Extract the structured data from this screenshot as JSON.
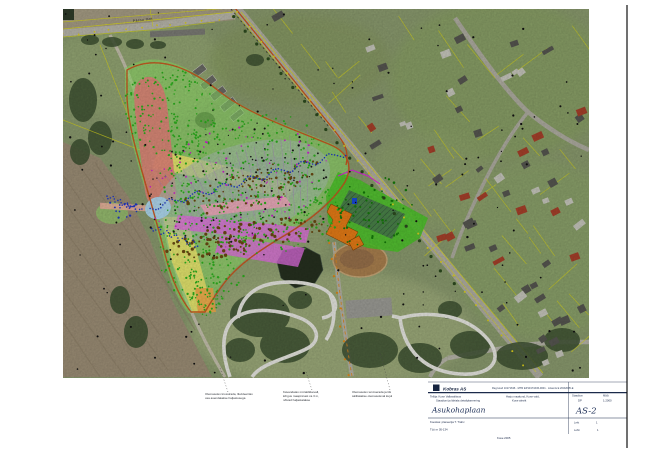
{
  "road_label": "Pärnu mnt",
  "notes": [
    {
      "lines": [
        "Olemasolev krossirada, likvideeritav",
        "osa asendatakse haljastusega"
      ]
    },
    {
      "lines": [
        "Kavandatav müratõkkevall,",
        "kõrgus maapinnast ca 3 m,",
        "nõlvad haljastatakse"
      ]
    },
    {
      "lines": [
        "Olemasolev terviserada ja tiik",
        "säilitatakse olemasoleval kujul"
      ]
    }
  ],
  "title_block": {
    "logo_text": "Kobras AS",
    "top_refs": "Reg kood 10171636  ·  MTR EP10171636-0001  ·  Litsents E 203/2005-E",
    "client_label": "Tellija: Kose Vallavalitsus",
    "project_label": "Staadioni ja lähiala detailplaneering",
    "location_line1": "Harju maakond, Kose vald,",
    "location_line2": "Kose alevik",
    "stage_label": "Staadium",
    "stage_value": "DP",
    "scale_label": "Mõõt",
    "scale_value": "1:2000",
    "title_big": "Asukohaplaan",
    "number_big": "AS-2",
    "author_line": "Koostas: planeerija T. Trahv",
    "work_no_line": "Töö nr 05-134",
    "sheet_label": "Leht",
    "sheet_value": "1",
    "sheets_label": "Lehti",
    "sheets_value": "1",
    "footer_center": "Kose 2005"
  },
  "colors": {
    "overlay_green": "#8fe868",
    "zone_red": "#e2837a",
    "zone_yellow": "#f2ea6e",
    "zone_orange": "#f0a84a",
    "zone_magenta": "#e26ee2",
    "zone_pink": "#f2a8bc",
    "zone_blue": "#aed9f2",
    "zone_salmon_strip": "#f0b0a0",
    "oval_fill": "#a9bfae",
    "oval_hatch": "#b07ad0",
    "facility_green": "#4cc32a",
    "facility_orange": "#e57b16",
    "boundary_orange": "#c8551e",
    "navy": "#1b2a4a"
  },
  "map": {
    "oval": {
      "cx": 243,
      "cy": 190,
      "rx": 90,
      "ry": 45,
      "rot": -17,
      "hatch_n": 18
    },
    "dot_groups": [
      {
        "seed": 21,
        "cx": 170,
        "cy": 112,
        "rx": 48,
        "ry": 44,
        "rot": 0,
        "n": 150,
        "color": "#2db01e",
        "r": 0.7,
        "rv": 0.5
      },
      {
        "seed": 22,
        "cx": 240,
        "cy": 162,
        "rx": 82,
        "ry": 46,
        "rot": -15,
        "n": 220,
        "color": "#2db01e",
        "r": 0.7,
        "rv": 0.5
      },
      {
        "seed": 23,
        "cx": 205,
        "cy": 245,
        "rx": 48,
        "ry": 58,
        "rot": 5,
        "n": 170,
        "color": "#2db01e",
        "r": 0.7,
        "rv": 0.5
      },
      {
        "seed": 24,
        "cx": 290,
        "cy": 220,
        "rx": 58,
        "ry": 38,
        "rot": -20,
        "n": 130,
        "color": "#2db01e",
        "r": 0.7,
        "rv": 0.5
      },
      {
        "seed": 25,
        "cx": 205,
        "cy": 292,
        "rx": 20,
        "ry": 26,
        "rot": 0,
        "n": 45,
        "color": "#2db01e",
        "r": 0.7,
        "rv": 0.5
      },
      {
        "seed": 31,
        "cx": 235,
        "cy": 185,
        "rx": 95,
        "ry": 60,
        "rot": -15,
        "n": 90,
        "color": "#1c1c1c",
        "r": 0.6,
        "rv": 0.5
      },
      {
        "seed": 32,
        "cx": 235,
        "cy": 185,
        "rx": 95,
        "ry": 60,
        "rot": -15,
        "n": 70,
        "color": "#d020d0",
        "r": 0.6,
        "rv": 0.5
      },
      {
        "seed": 33,
        "cx": 245,
        "cy": 238,
        "rx": 80,
        "ry": 16,
        "rot": -10,
        "n": 110,
        "color": "#6b4a12",
        "r": 0.9,
        "rv": 0.8
      },
      {
        "seed": 34,
        "cx": 250,
        "cy": 188,
        "rx": 75,
        "ry": 18,
        "rot": -17,
        "n": 80,
        "color": "#6b4a12",
        "r": 0.8,
        "rv": 0.7
      },
      {
        "seed": 35,
        "cx": 372,
        "cy": 212,
        "rx": 42,
        "ry": 34,
        "rot": -20,
        "n": 55,
        "color": "#157a0a",
        "r": 0.8,
        "rv": 0.5
      },
      {
        "seed": 36,
        "cx": 122,
        "cy": 208,
        "rx": 16,
        "ry": 10,
        "rot": 0,
        "n": 16,
        "color": "#2038c8",
        "r": 0.8,
        "rv": 0.4
      }
    ],
    "waves": [
      {
        "seed": 41,
        "x1": 150,
        "y1": 208,
        "x2": 345,
        "y2": 153,
        "n": 78,
        "amp": 3.2,
        "freq": 46,
        "color": "#2038c8",
        "r": 0.8
      },
      {
        "seed": 42,
        "x1": 107,
        "y1": 196,
        "x2": 141,
        "y2": 211,
        "n": 20,
        "amp": 2.2,
        "freq": 30,
        "color": "#2038c8",
        "r": 0.8
      },
      {
        "seed": 43,
        "x1": 152,
        "y1": 228,
        "x2": 198,
        "y2": 245,
        "n": 24,
        "amp": 2.6,
        "freq": 34,
        "color": "#2038c8",
        "r": 0.8
      }
    ],
    "road_dots": [
      {
        "seed": 51,
        "x1": 242,
        "y1": 10,
        "x2": 540,
        "y2": 376,
        "n": 26,
        "off": 5,
        "color": "#ddcf1e",
        "r": 1.0
      },
      {
        "seed": 52,
        "x1": 63,
        "y1": 31,
        "x2": 233,
        "y2": 14,
        "n": 12,
        "off": 4,
        "color": "#ddcf1e",
        "r": 0.9
      },
      {
        "seed": 53,
        "x1": 242,
        "y1": 10,
        "x2": 460,
        "y2": 278,
        "n": 20,
        "off": 9,
        "color": "#2c4a1e",
        "r": 1.6
      },
      {
        "seed": 54,
        "x1": 334,
        "y1": 242,
        "x2": 352,
        "y2": 374,
        "n": 9,
        "off": 4,
        "color": "#e08818",
        "r": 1.1
      }
    ],
    "scatter": {
      "seed": 3,
      "n": 150,
      "color": "#101010"
    },
    "houses": {
      "seed": 7,
      "n": 62
    },
    "parcels": {
      "seed": 11,
      "n": 40
    }
  }
}
